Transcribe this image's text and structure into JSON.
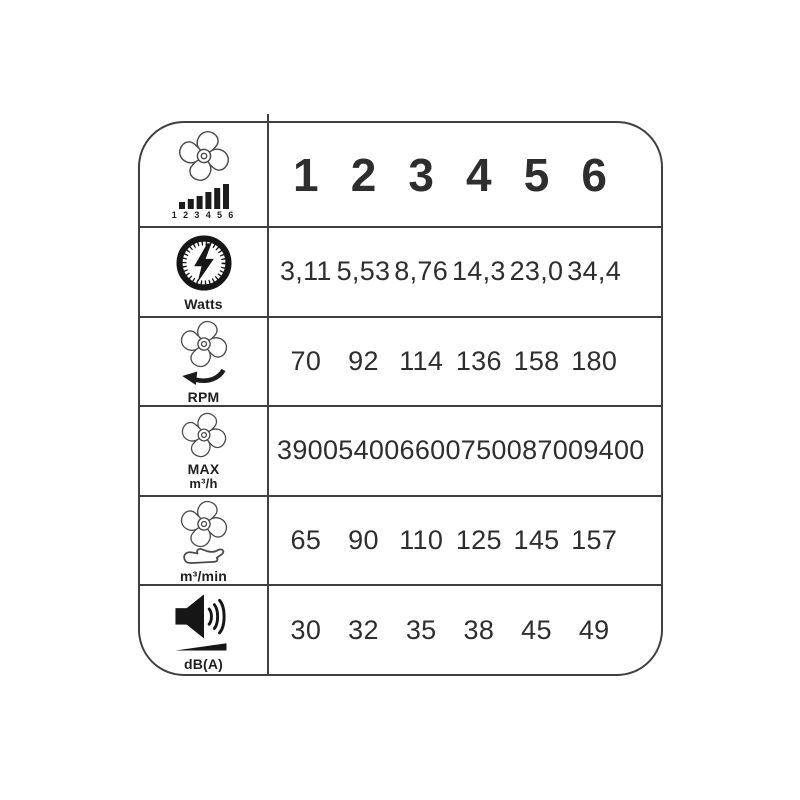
{
  "chart_data": {
    "type": "table",
    "columns": [
      "1",
      "2",
      "3",
      "4",
      "5",
      "6"
    ],
    "rows": [
      {
        "metric": "Watts",
        "values": [
          "3,11",
          "5,53",
          "8,76",
          "14,3",
          "23,0",
          "34,4"
        ]
      },
      {
        "metric": "RPM",
        "values": [
          "70",
          "92",
          "114",
          "136",
          "158",
          "180"
        ]
      },
      {
        "metric": "MAX m³/h",
        "values": [
          "3900",
          "5400",
          "6600",
          "7500",
          "8700",
          "9400"
        ]
      },
      {
        "metric": "m³/min",
        "values": [
          "65",
          "90",
          "110",
          "125",
          "145",
          "157"
        ]
      },
      {
        "metric": "dB(A)",
        "values": [
          "30",
          "32",
          "35",
          "38",
          "45",
          "49"
        ]
      }
    ]
  },
  "header": {
    "speed_scale_digits": "1 2 3 4 5 6"
  },
  "labels": {
    "watts": "Watts",
    "rpm": "RPM",
    "max": "MAX",
    "m3h": "m³/h",
    "m3min": "m³/min",
    "dba": "dB(A)"
  },
  "icons": {
    "header": "fan-speed-bars-icon",
    "watts": "power-gauge-lightning-icon",
    "rpm": "fan-rotation-arrow-icon",
    "max": "fan-icon",
    "m3min": "fan-on-hand-icon",
    "dba": "speaker-volume-icon"
  },
  "colors": {
    "ink": "#2e2e2e",
    "line": "#3f3f3f",
    "background": "#ffffff"
  }
}
